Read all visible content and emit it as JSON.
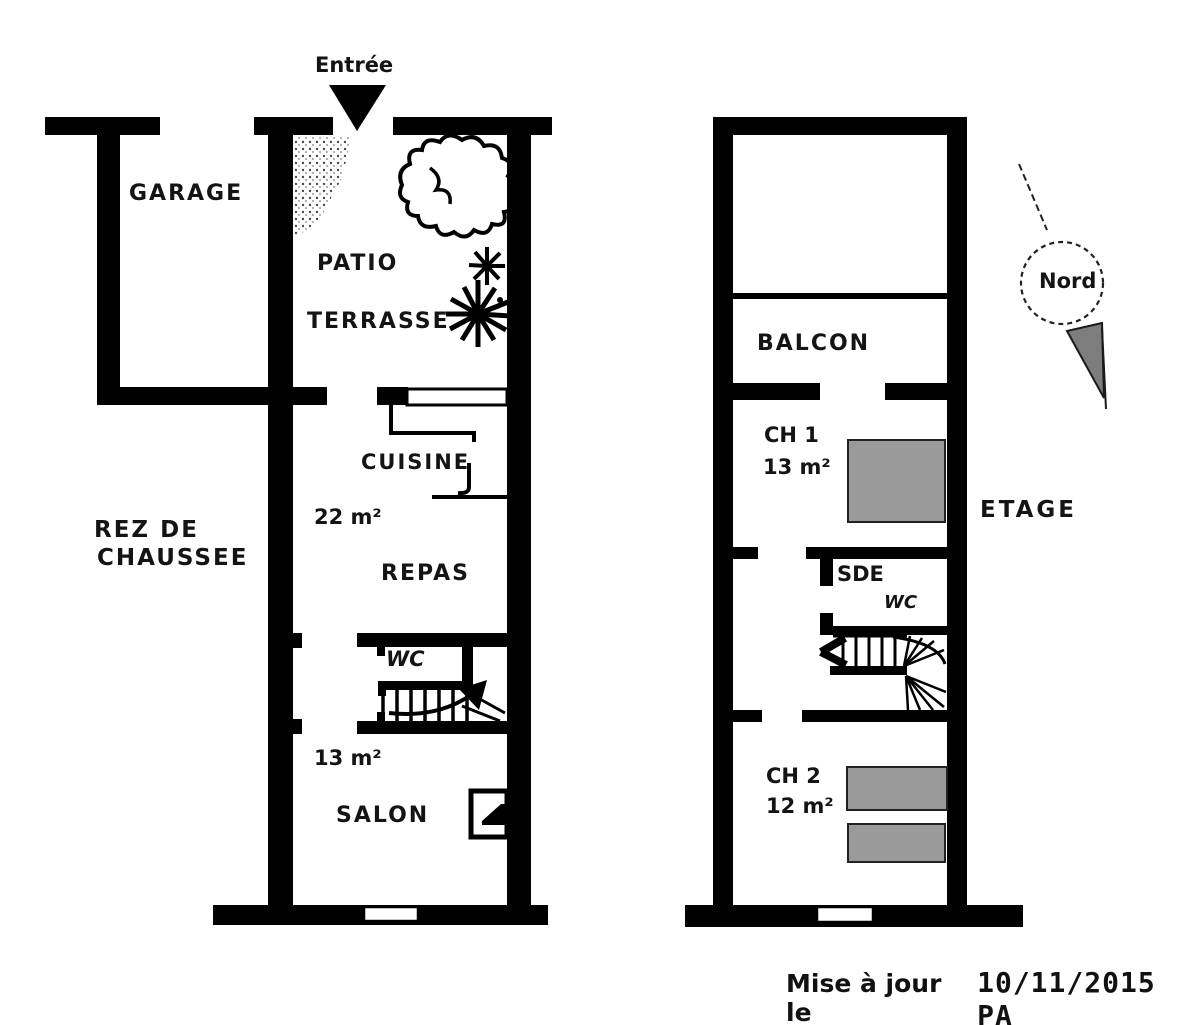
{
  "ground_floor": {
    "entrance_label": "Entrée",
    "floor_label_line1": "REZ DE",
    "floor_label_line2": "CHAUSSEE",
    "rooms": {
      "garage": "GARAGE",
      "patio": "PATIO",
      "terrasse": "TERRASSE",
      "cuisine": "CUISINE",
      "cuisine_area": "22 m²",
      "repas": "REPAS",
      "wc": "WC",
      "salon_area": "13 m²",
      "salon": "SALON"
    }
  },
  "upper_floor": {
    "floor_label": "ETAGE",
    "rooms": {
      "balcon": "BALCON",
      "ch1": "CH 1",
      "ch1_area": "13 m²",
      "sde": "SDE",
      "wc": "WC",
      "ch2": "CH 2",
      "ch2_area": "12 m²"
    }
  },
  "compass": {
    "north_label": "Nord"
  },
  "footer": {
    "prefix": "Mise à jour le",
    "date": "10/11/2015 PA"
  },
  "colors": {
    "wall": "#000000",
    "bed_fill": "#9a9a9a",
    "compass_fill": "#7d7d7d"
  }
}
